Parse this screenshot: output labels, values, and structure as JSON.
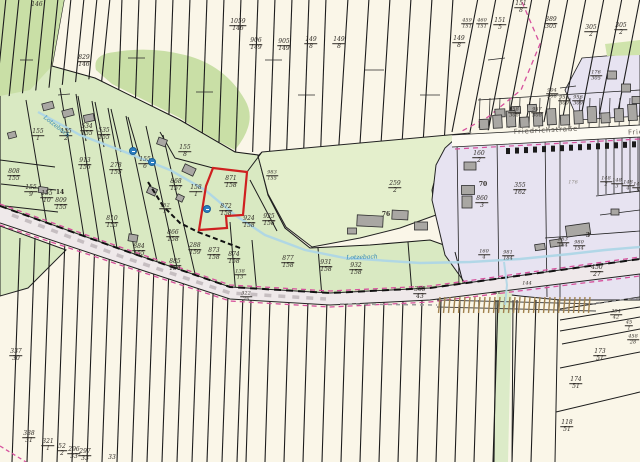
{
  "map": {
    "type": "cadastral-parcel-map",
    "colors": {
      "label": "#2f2b26",
      "street": "#5f5a52",
      "water": "#2f86b5",
      "faint": "#8a857e",
      "highlight_outline": "#cf2020",
      "meadow_green": "#e4efcc",
      "village_green": "#d9e9c2",
      "forest_green": "#c9dfa6",
      "settlement_purple": "#e7e3f1",
      "field_cream": "#faf6e8",
      "boundary_pink": "#d6519d",
      "stream_blue": "#aed6e6",
      "railway_brown": "#a1824f"
    },
    "highlighted_parcel": {
      "n": "872",
      "d": "158"
    },
    "parcel_labels": [
      {
        "n": "829",
        "d": "146",
        "x": 84,
        "y": 62
      },
      {
        "n": "1059",
        "d": "146",
        "x": 238,
        "y": 26
      },
      {
        "n": "906",
        "d": "149",
        "x": 256,
        "y": 45
      },
      {
        "n": "905",
        "d": "149",
        "x": 284,
        "y": 46
      },
      {
        "n": "149",
        "d": "8",
        "x": 311,
        "y": 44
      },
      {
        "n": "149",
        "d": "8",
        "x": 339,
        "y": 44
      },
      {
        "n": "149",
        "d": "8",
        "x": 459,
        "y": 43
      },
      {
        "n": "459",
        "d": "151",
        "x": 467,
        "y": 24,
        "s": 5
      },
      {
        "n": "460",
        "d": "151",
        "x": 482,
        "y": 24,
        "s": 5
      },
      {
        "n": "151",
        "d": "5",
        "x": 500,
        "y": 25
      },
      {
        "n": "151",
        "d": "8",
        "x": 521,
        "y": 8
      },
      {
        "n": "389",
        "d": "305",
        "x": 551,
        "y": 24
      },
      {
        "n": "305",
        "d": "2",
        "x": 591,
        "y": 32
      },
      {
        "n": "305",
        "d": "2",
        "x": 621,
        "y": 30
      },
      {
        "n": "176",
        "d": "305",
        "x": 596,
        "y": 76,
        "s": 5
      },
      {
        "n": "904",
        "d": "308",
        "x": 552,
        "y": 94,
        "s": 5
      },
      {
        "n": "955",
        "d": "309",
        "x": 564,
        "y": 101,
        "s": 5
      },
      {
        "n": "956",
        "d": "309",
        "x": 578,
        "y": 101,
        "s": 5
      },
      {
        "n": "957",
        "d": "308",
        "x": 537,
        "y": 113,
        "s": 5
      },
      {
        "n": "958",
        "d": "308",
        "x": 514,
        "y": 113,
        "s": 5
      },
      {
        "n": "160",
        "d": "2",
        "x": 479,
        "y": 158
      },
      {
        "n": "860",
        "d": "3",
        "x": 482,
        "y": 203
      },
      {
        "n": "355",
        "d": "162",
        "x": 520,
        "y": 190
      },
      {
        "n": "983",
        "d": "154",
        "x": 563,
        "y": 243,
        "s": 5
      },
      {
        "n": "980",
        "d": "154",
        "x": 579,
        "y": 246,
        "s": 5
      },
      {
        "n": "981",
        "d": "184",
        "x": 508,
        "y": 256,
        "s": 5
      },
      {
        "n": "160",
        "d": "4",
        "x": 484,
        "y": 255,
        "s": 5
      },
      {
        "n": "148",
        "d": "2",
        "x": 606,
        "y": 182,
        "s": 5
      },
      {
        "n": "148",
        "d": "3",
        "x": 617,
        "y": 184,
        "s": 5
      },
      {
        "n": "148",
        "d": "4",
        "x": 628,
        "y": 186,
        "s": 5
      },
      {
        "n": "148",
        "d": "5",
        "x": 638,
        "y": 188,
        "s": 5
      },
      {
        "n": "259",
        "d": "2",
        "x": 395,
        "y": 188
      },
      {
        "n": "155",
        "d": "1",
        "x": 38,
        "y": 136
      },
      {
        "n": "155",
        "d": "2",
        "x": 66,
        "y": 136
      },
      {
        "n": "534",
        "d": "155",
        "x": 87,
        "y": 131
      },
      {
        "n": "535",
        "d": "155",
        "x": 104,
        "y": 135
      },
      {
        "n": "913",
        "d": "155",
        "x": 85,
        "y": 165
      },
      {
        "n": "278",
        "d": "155",
        "x": 116,
        "y": 170
      },
      {
        "n": "155",
        "d": "6",
        "x": 145,
        "y": 164
      },
      {
        "n": "808",
        "d": "155",
        "x": 14,
        "y": 176
      },
      {
        "n": "155",
        "d": "9",
        "x": 31,
        "y": 192
      },
      {
        "n": "155",
        "d": "10",
        "x": 47,
        "y": 198
      },
      {
        "n": "809",
        "d": "155",
        "x": 61,
        "y": 205
      },
      {
        "n": "810",
        "d": "155",
        "x": 112,
        "y": 223
      },
      {
        "n": "884",
        "d": "155",
        "x": 139,
        "y": 251
      },
      {
        "n": "866",
        "d": "158",
        "x": 173,
        "y": 237
      },
      {
        "n": "885",
        "d": "154",
        "x": 175,
        "y": 266
      },
      {
        "n": "288",
        "d": "159",
        "x": 195,
        "y": 250
      },
      {
        "n": "873",
        "d": "158",
        "x": 214,
        "y": 255
      },
      {
        "n": "874",
        "d": "158",
        "x": 234,
        "y": 259
      },
      {
        "n": "877",
        "d": "158",
        "x": 288,
        "y": 263
      },
      {
        "n": "924",
        "d": "158",
        "x": 249,
        "y": 223
      },
      {
        "n": "925",
        "d": "158",
        "x": 269,
        "y": 221
      },
      {
        "n": "871",
        "d": "158",
        "x": 231,
        "y": 183
      },
      {
        "n": "872",
        "d": "158",
        "x": 226,
        "y": 211
      },
      {
        "n": "868",
        "d": "157",
        "x": 176,
        "y": 186
      },
      {
        "n": "158",
        "d": "1",
        "x": 196,
        "y": 192
      },
      {
        "n": "155",
        "d": "8",
        "x": 185,
        "y": 152
      },
      {
        "n": "983",
        "d": "155",
        "x": 272,
        "y": 176,
        "s": 5
      },
      {
        "n": "152",
        "d": "2",
        "x": 165,
        "y": 209,
        "s": 5
      },
      {
        "n": "931",
        "d": "158",
        "x": 326,
        "y": 267
      },
      {
        "n": "932",
        "d": "158",
        "x": 356,
        "y": 270
      },
      {
        "n": "365",
        "d": "43",
        "x": 420,
        "y": 294
      },
      {
        "n": "322",
        "d": "25",
        "x": 246,
        "y": 297,
        "s": 5
      },
      {
        "n": "450",
        "d": "27",
        "x": 597,
        "y": 272
      },
      {
        "n": "394",
        "d": "42",
        "x": 616,
        "y": 315,
        "s": 5
      },
      {
        "n": "45",
        "d": "1",
        "x": 629,
        "y": 326,
        "s": 5
      },
      {
        "n": "458",
        "d": "28",
        "x": 633,
        "y": 340,
        "s": 5
      },
      {
        "n": "173",
        "d": "51",
        "x": 600,
        "y": 356
      },
      {
        "n": "174",
        "d": "51",
        "x": 576,
        "y": 384
      },
      {
        "n": "118",
        "d": "51",
        "x": 567,
        "y": 427
      },
      {
        "n": "337",
        "d": "30",
        "x": 16,
        "y": 356
      },
      {
        "n": "338",
        "d": "31",
        "x": 29,
        "y": 438
      },
      {
        "n": "321",
        "d": "1",
        "x": 48,
        "y": 446
      },
      {
        "n": "52",
        "d": "2",
        "x": 62,
        "y": 451
      },
      {
        "n": "296",
        "d": "33",
        "x": 74,
        "y": 454
      },
      {
        "n": "297",
        "d": "33",
        "x": 85,
        "y": 456
      },
      {
        "n": "138",
        "d": "13",
        "x": 240,
        "y": 275,
        "s": 5
      }
    ],
    "text_labels": [
      {
        "t": "146",
        "x": 37,
        "y": 5
      },
      {
        "t": "14",
        "x": 60,
        "y": 193,
        "b": true
      },
      {
        "t": "70",
        "x": 483,
        "y": 185,
        "b": true
      },
      {
        "t": "76",
        "x": 386,
        "y": 215,
        "b": true
      },
      {
        "t": "3",
        "x": 588,
        "y": 236,
        "b": true
      },
      {
        "t": "33",
        "x": 112,
        "y": 458
      },
      {
        "t": "144",
        "x": 527,
        "y": 284,
        "s": 5
      },
      {
        "t": "176",
        "x": 573,
        "y": 183,
        "s": 5,
        "c": "faint"
      },
      {
        "t": "Friedrichstraße",
        "x": 546,
        "y": 131,
        "c": "street",
        "r": -3,
        "s": 7,
        "st": true
      },
      {
        "t": "Frie",
        "x": 636,
        "y": 133,
        "c": "street",
        "r": -3,
        "s": 7,
        "st": true
      },
      {
        "t": "Lotzebach",
        "x": 56,
        "y": 127,
        "c": "water",
        "r": 38,
        "s": 6
      },
      {
        "t": "Lotzebach",
        "x": 362,
        "y": 258,
        "c": "water",
        "r": -2,
        "s": 6
      }
    ],
    "water_points": [
      {
        "x": 133,
        "y": 151
      },
      {
        "x": 152,
        "y": 162
      },
      {
        "x": 207,
        "y": 209
      }
    ]
  }
}
